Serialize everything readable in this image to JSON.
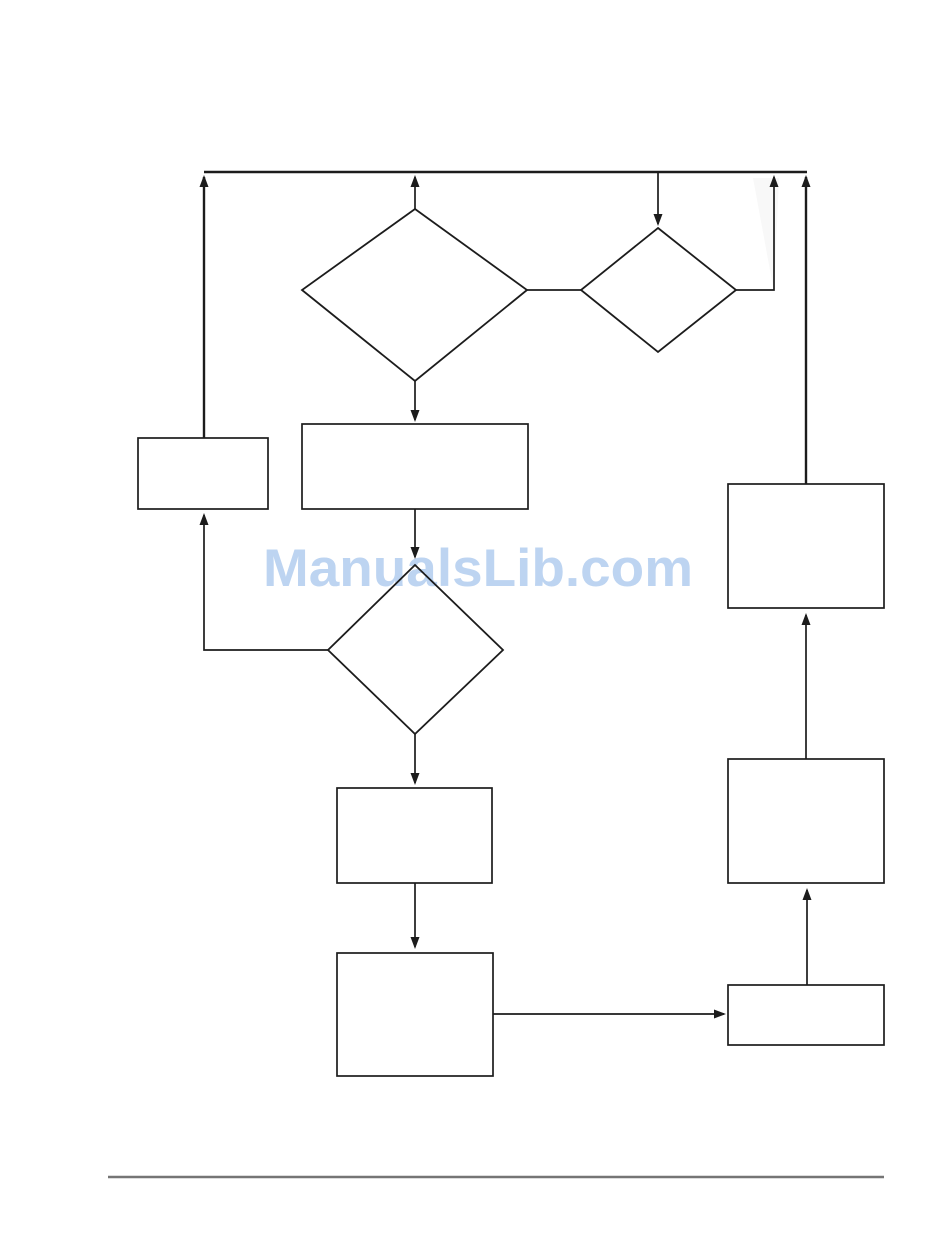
{
  "watermark": {
    "text": "ManualsLib.com",
    "color": "#bdd4f1"
  },
  "diagram": {
    "background": "#ffffff",
    "stroke_color": "#1c1c1c",
    "arrow_color": "#1c1c1c",
    "footer_rule_color": "#757575",
    "nodes": {
      "decision_diamond_main_label": "",
      "decision_diamond_secondary_label": "",
      "decision_diamond_lower_label": "",
      "process_box_left_label": "",
      "process_box_top_center_label": "",
      "process_box_mid_label": "",
      "process_box_bottom_label": "",
      "process_box_right_top_label": "",
      "process_box_right_mid_label": "",
      "process_box_right_bottom_label": ""
    }
  }
}
